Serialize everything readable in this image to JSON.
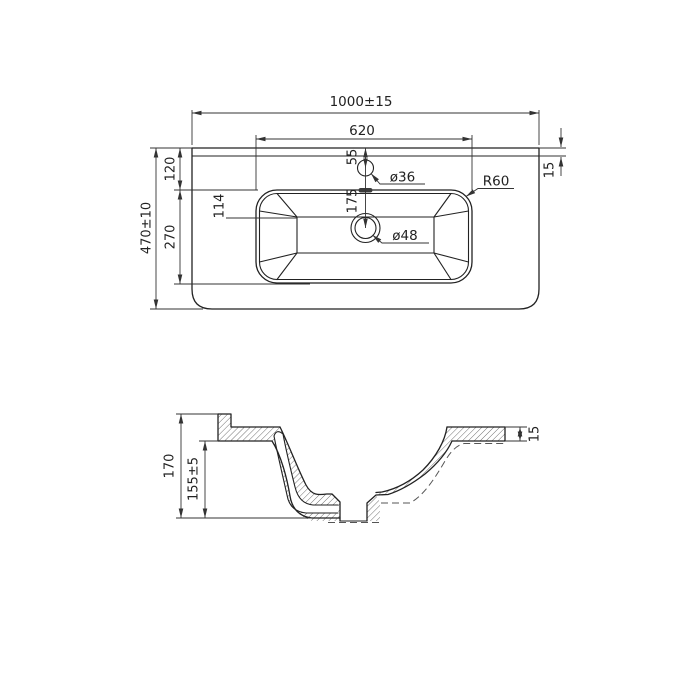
{
  "drawing_title": "washbasin-technical-drawing",
  "colors": {
    "line": "#222222",
    "dim_line": "#333333",
    "background": "#ffffff"
  },
  "top_view": {
    "overall_width": "1000±15",
    "basin_width": "620",
    "overall_depth": "470±10",
    "back_offset": "120",
    "basin_depth": "270",
    "basin_floor_offset": "114",
    "faucet_center_offset": "55",
    "faucet_to_drain": "175",
    "faucet_hole_diameter": "ø36",
    "drain_hole_diameter": "ø48",
    "corner_radius": "R60",
    "back_ledge": "15"
  },
  "section_view": {
    "overall_height": "170",
    "bowl_height": "155±5",
    "rim_thickness": "15"
  }
}
